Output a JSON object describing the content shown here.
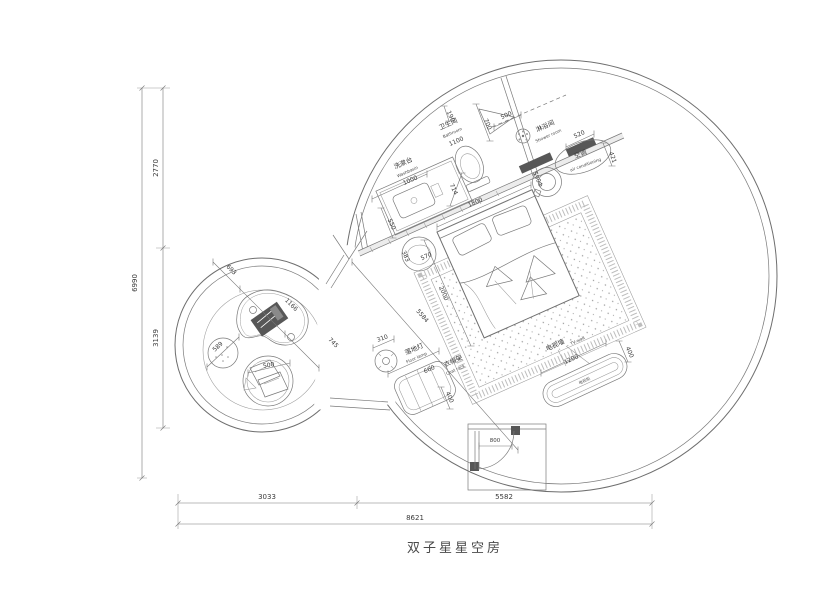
{
  "title": "双子星星空房",
  "rooms": {
    "washbasin_cn": "洗漱台",
    "washbasin_en": "Washbasin",
    "bathroom_cn": "卫生间",
    "bathroom_en": "Bathroom",
    "shower_cn": "淋浴间",
    "shower_en": "Shower room",
    "ac_cn": "空调",
    "ac_en": "air conditioning",
    "lamp_cn": "落地灯",
    "lamp_en": "Floor lamp",
    "coat_cn": "衣帽架",
    "coat_en": "Coat rack",
    "tv_cn": "电视墙",
    "tv_en": "TV wall",
    "tv_cabinet": "电视柜"
  },
  "dims": {
    "left_total": "6990",
    "left_top": "2770",
    "left_bottom": "3139",
    "bottom_left": "3033",
    "bottom_right": "5582",
    "bottom_total": "8621",
    "chain_1": "693",
    "chain_2": "1166",
    "chain_3": "745",
    "pouf": "589",
    "chair": "500",
    "washbasin": "1000",
    "bathroom": "1100",
    "bed_w": "1800",
    "bed_l": "2000",
    "room_diag": "5584",
    "wall": "190",
    "toilet_space": "700",
    "shower_door": "500",
    "counter_depth": "550",
    "toilet_off": "714",
    "fan": "590Φ",
    "bench": "520",
    "ac": "421",
    "stool_off": "383",
    "stool": "570",
    "lamp": "310",
    "coat_w": "660",
    "coat_d": "400",
    "tv_w": "1200",
    "tv_d": "400",
    "door": "800"
  }
}
